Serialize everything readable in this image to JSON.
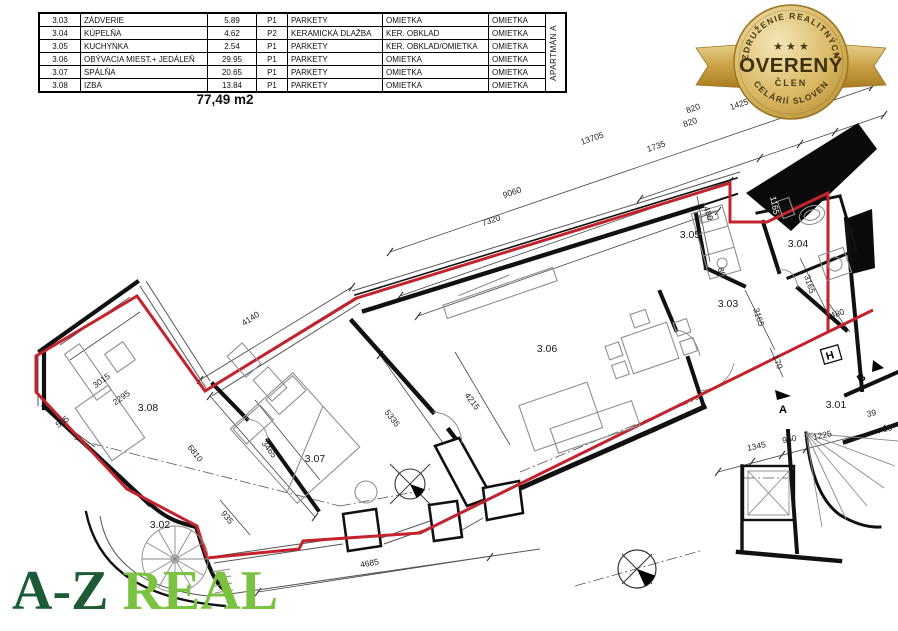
{
  "table": {
    "rows": [
      {
        "id": "3.03",
        "name": "ZÁDVERIE",
        "area": "5.89",
        "layer": "P1",
        "floor": "PARKETY",
        "walls": "OMIETKA",
        "ceiling": "OMIETKA"
      },
      {
        "id": "3.04",
        "name": "KÚPELŇA",
        "area": "4.62",
        "layer": "P2",
        "floor": "KERAMICKÁ DLAŽBA",
        "walls": "KER. OBKLAD",
        "ceiling": "OMIETKA"
      },
      {
        "id": "3.05",
        "name": "KUCHYNKA",
        "area": "2.54",
        "layer": "P1",
        "floor": "PARKETY",
        "walls": "KER. OBKLAD/OMIETKA",
        "ceiling": "OMIETKA"
      },
      {
        "id": "3.06",
        "name": "OBÝVACIA MIEST.+ JEDÁLEŇ",
        "area": "29.95",
        "layer": "P1",
        "floor": "PARKETY",
        "walls": "OMIETKA",
        "ceiling": "OMIETKA"
      },
      {
        "id": "3.07",
        "name": "SPÁLŇA",
        "area": "20.65",
        "layer": "P1",
        "floor": "PARKETY",
        "walls": "OMIETKA",
        "ceiling": "OMIETKA"
      },
      {
        "id": "3.08",
        "name": "IZBA",
        "area": "13.84",
        "layer": "P1",
        "floor": "PARKETY",
        "walls": "OMIETKA",
        "ceiling": "OMIETKA"
      }
    ],
    "apartment_label": "APARTMÁN A",
    "total_area": "77,49 m2"
  },
  "badge": {
    "arc_top": "ZDRUŽENIE REALITNÝCH",
    "stars": "★ ★ ★",
    "title": "OVERENÝ",
    "subtitle": "ČLEN",
    "arc_bottom": "KANCELÁRIÍ SLOVENSKA",
    "gold": "#c9a13b"
  },
  "logo": {
    "part1": "A-Z",
    "part2": " REAL",
    "color_dark": "#1c5b36",
    "color_light": "#7cc241"
  },
  "plan": {
    "boundary_color": "#c2232c",
    "rooms": [
      "3.01",
      "3.02",
      "3.03",
      "3.04",
      "3.05",
      "3.06",
      "3.07",
      "3.08"
    ],
    "dims": [
      "13705",
      "1735",
      "820",
      "820",
      "1425",
      "9060",
      "7320",
      "4140",
      "3015",
      "2295",
      "595",
      "6810",
      "3465",
      "5335",
      "4215",
      "935",
      "4685",
      "3165",
      "3165",
      "1480",
      "1480",
      "80",
      "170",
      "1165",
      "1345",
      "950",
      "1225",
      "39",
      "15"
    ],
    "markers": {
      "a": "A",
      "b": "B",
      "h": "H"
    }
  }
}
